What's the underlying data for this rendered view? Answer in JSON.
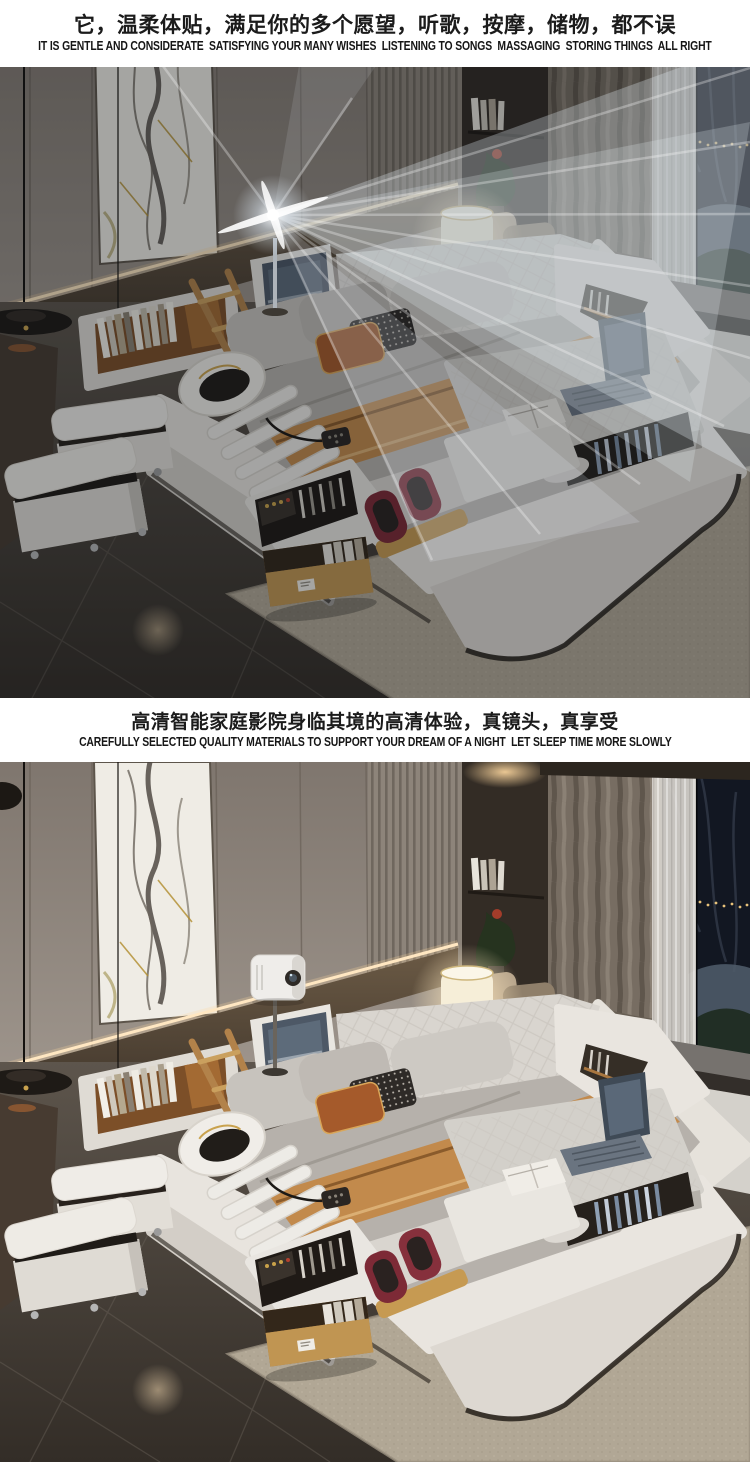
{
  "page": {
    "width": 750,
    "height": 1462,
    "background": "#ffffff"
  },
  "sections": {
    "top_header": {
      "title_zh": "它，温柔体贴，满足你的多个愿望，听歌，按摩，储物，都不误",
      "subtitle_en": "IT IS GENTLE AND CONSIDERATE  SATISFYING YOUR MANY WISHES  LISTENING TO SONGS  MASSAGING  STORING THINGS  ALL RIGHT"
    },
    "mid_header": {
      "title_zh": "高清智能家庭影院身临其境的高清体验，真镜头，真享受",
      "subtitle_en": "CAREFULLY SELECTED QUALITY MATERIALS TO SUPPORT YOUR DREAM OF A NIGHT  LET SLEEP TIME MORE SLOWLY"
    }
  },
  "photos": [
    {
      "id": "photo-projection-beam",
      "description": "multifunctional smart leather bed at night with a projector light beam fanning across the bedroom",
      "objects": [
        "projector-beam",
        "lens-flare",
        "marble-wall-panel",
        "wall-panels",
        "pendant-lamp",
        "table-lamp",
        "headboard-bookshelf",
        "wooden-ladder-shelf",
        "media-screen",
        "massage-chaise",
        "neck-massager-ring",
        "foot-massager",
        "remote-control",
        "storage-ottoman",
        "open-wood-drawer",
        "footboard-desk",
        "laptop",
        "notebook",
        "window-night-view",
        "curtains",
        "sheer-curtain",
        "window-seat",
        "cushions",
        "area-rug",
        "tile-floor"
      ]
    },
    {
      "id": "photo-projector-device",
      "description": "same smart bed scene, white projector on a stand above the headboard, lights on",
      "objects": [
        "projector-device",
        "marble-wall-panel",
        "wall-panels",
        "pendant-lamp",
        "table-lamp",
        "headboard-bookshelf",
        "wooden-ladder-shelf",
        "media-screen",
        "massage-chaise",
        "neck-massager-ring",
        "foot-massager",
        "remote-control",
        "storage-ottoman",
        "open-wood-drawer",
        "footboard-desk",
        "laptop",
        "notebook",
        "window-night-view",
        "curtains",
        "sheer-curtain",
        "window-seat",
        "cushions",
        "area-rug",
        "tile-floor"
      ]
    }
  ],
  "colors": {
    "text": "#1b1b1b",
    "wall_taupe": "#968d84",
    "marble_white": "#efece5",
    "wood_tan": "#a87a3e",
    "leather_white": "#e8e4de",
    "duvet_gray": "#b6b1ab",
    "runner_camel": "#c28a4c",
    "pillow_rust": "#a55a2b",
    "massager_burgundy": "#7d2a36",
    "floor_dark": "#453e37",
    "rug_beige": "#b1a795",
    "led_warm": "#ffd9a0",
    "night_window": "#121722",
    "beam_white": "#eef4fa"
  }
}
